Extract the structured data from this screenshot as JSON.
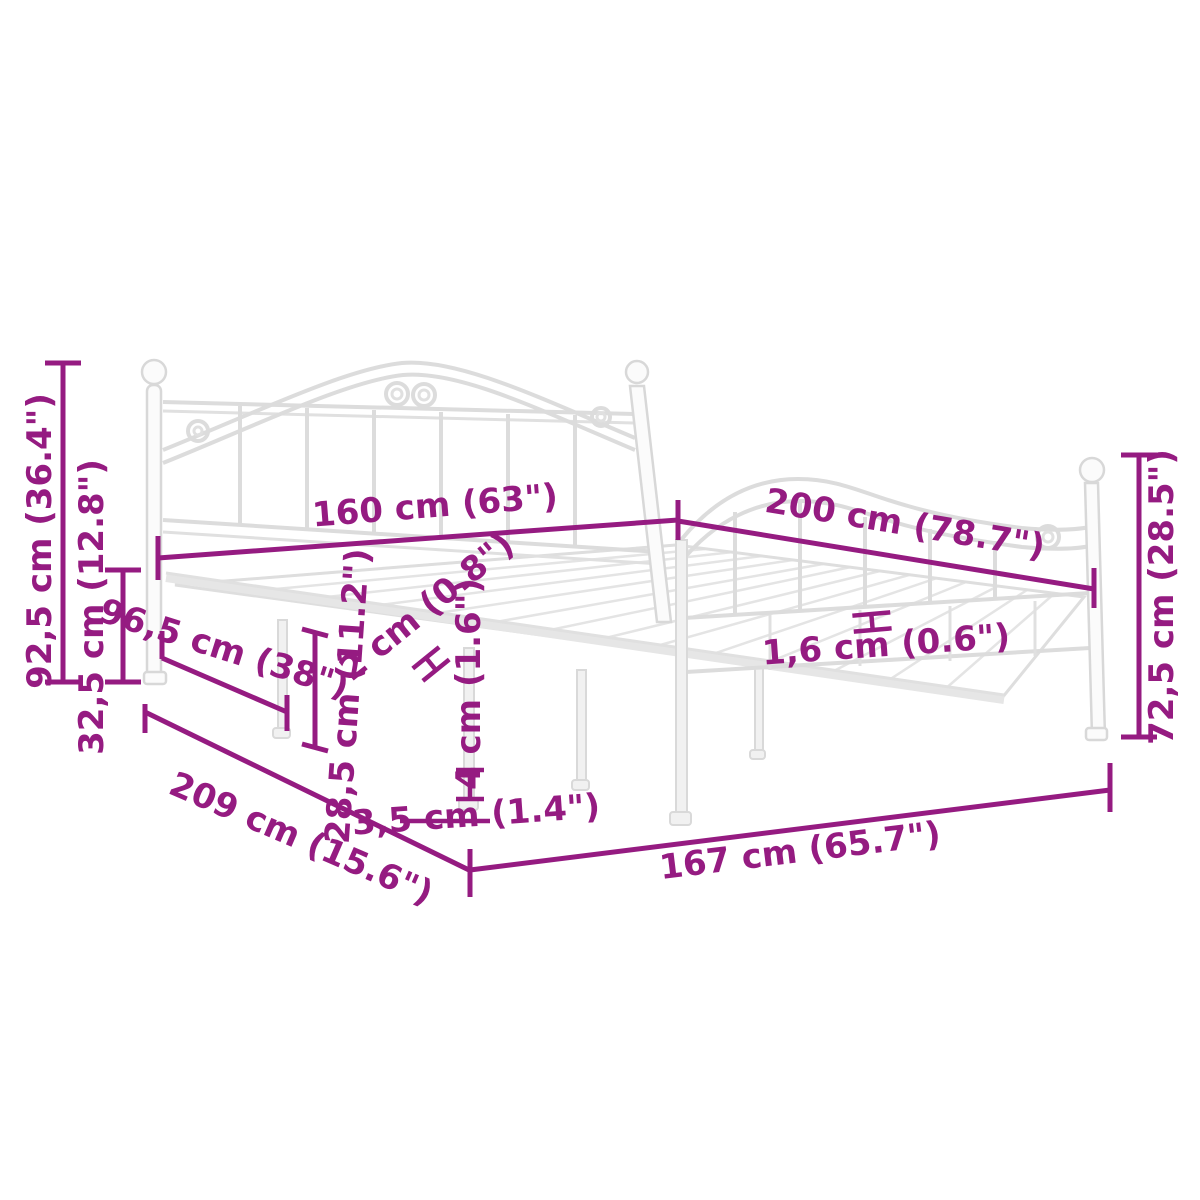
{
  "page": {
    "background_color": "#ffffff",
    "accent_color": "#951b81",
    "frame_color": "#dcdcdc",
    "subject": "white metal bed frame dimension diagram"
  },
  "diagram": {
    "dimensions": [
      {
        "name": "headboard-height",
        "label": "92,5 cm (36.4\")"
      },
      {
        "name": "base-height",
        "label": "32,5 cm (12.8\")"
      },
      {
        "name": "bed-width",
        "label": "160 cm (63\")"
      },
      {
        "name": "bed-length",
        "label": "200 cm (78.7\")"
      },
      {
        "name": "footboard-height",
        "label": "72,5 cm (28.5\")"
      },
      {
        "name": "side-rail-section",
        "label": "96,5 cm (38\")"
      },
      {
        "name": "under-bed-clearance",
        "label": "28,5 cm (11.2\")"
      },
      {
        "name": "tube-thickness",
        "label": "2 cm (0.8\")"
      },
      {
        "name": "leg-thickness",
        "label": "4 cm (1.6\")"
      },
      {
        "name": "slat-thickness",
        "label": "1,6 cm (0.6\")"
      },
      {
        "name": "frame-length",
        "label": "209 cm (15.6\")"
      },
      {
        "name": "frame-width",
        "label": "167 cm (65.7\")"
      },
      {
        "name": "foot-thickness",
        "label": "3,5 cm (1.4\")"
      }
    ]
  }
}
